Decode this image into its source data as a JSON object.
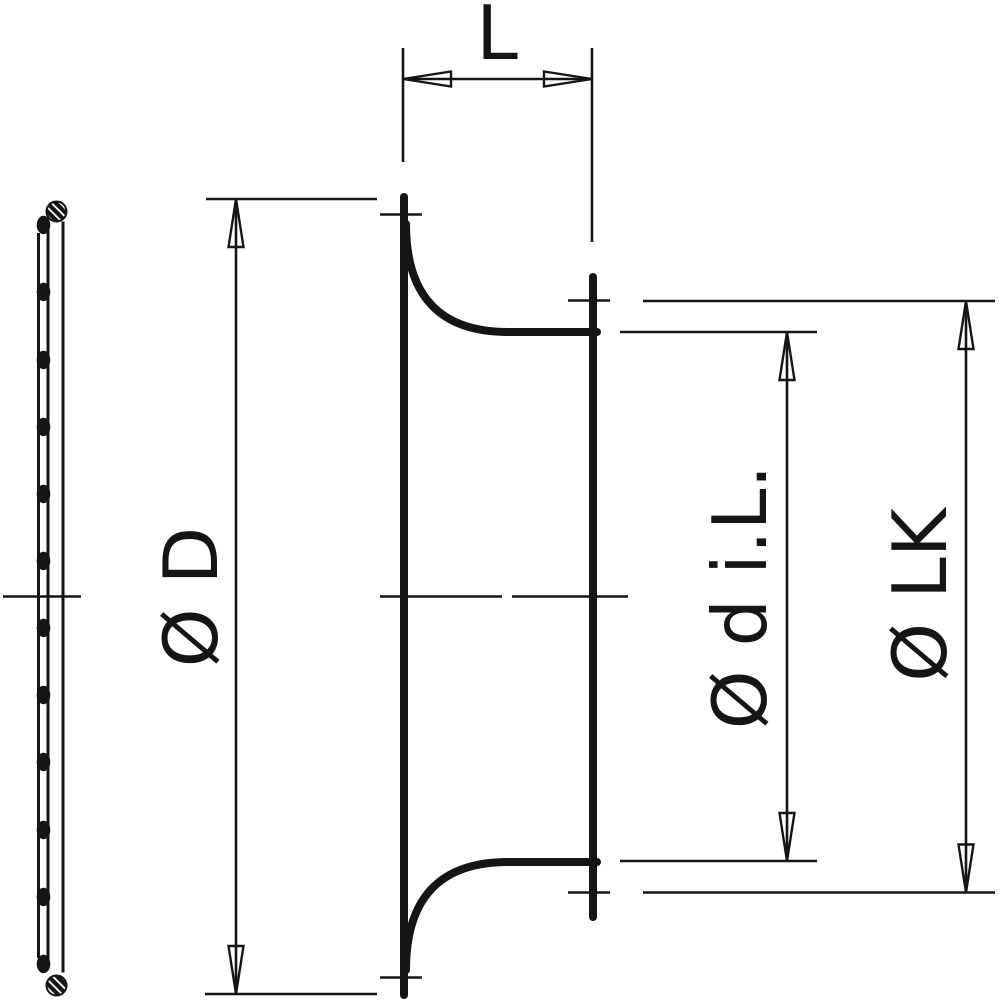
{
  "drawing": {
    "colors": {
      "line": "#151515",
      "background": "#ffffff"
    },
    "dimensions": {
      "length_label": "L",
      "outer_diameter_label": "Ø D",
      "inner_diameter_label": "Ø d i.L.",
      "bolt_circle_label": "Ø LK"
    }
  }
}
